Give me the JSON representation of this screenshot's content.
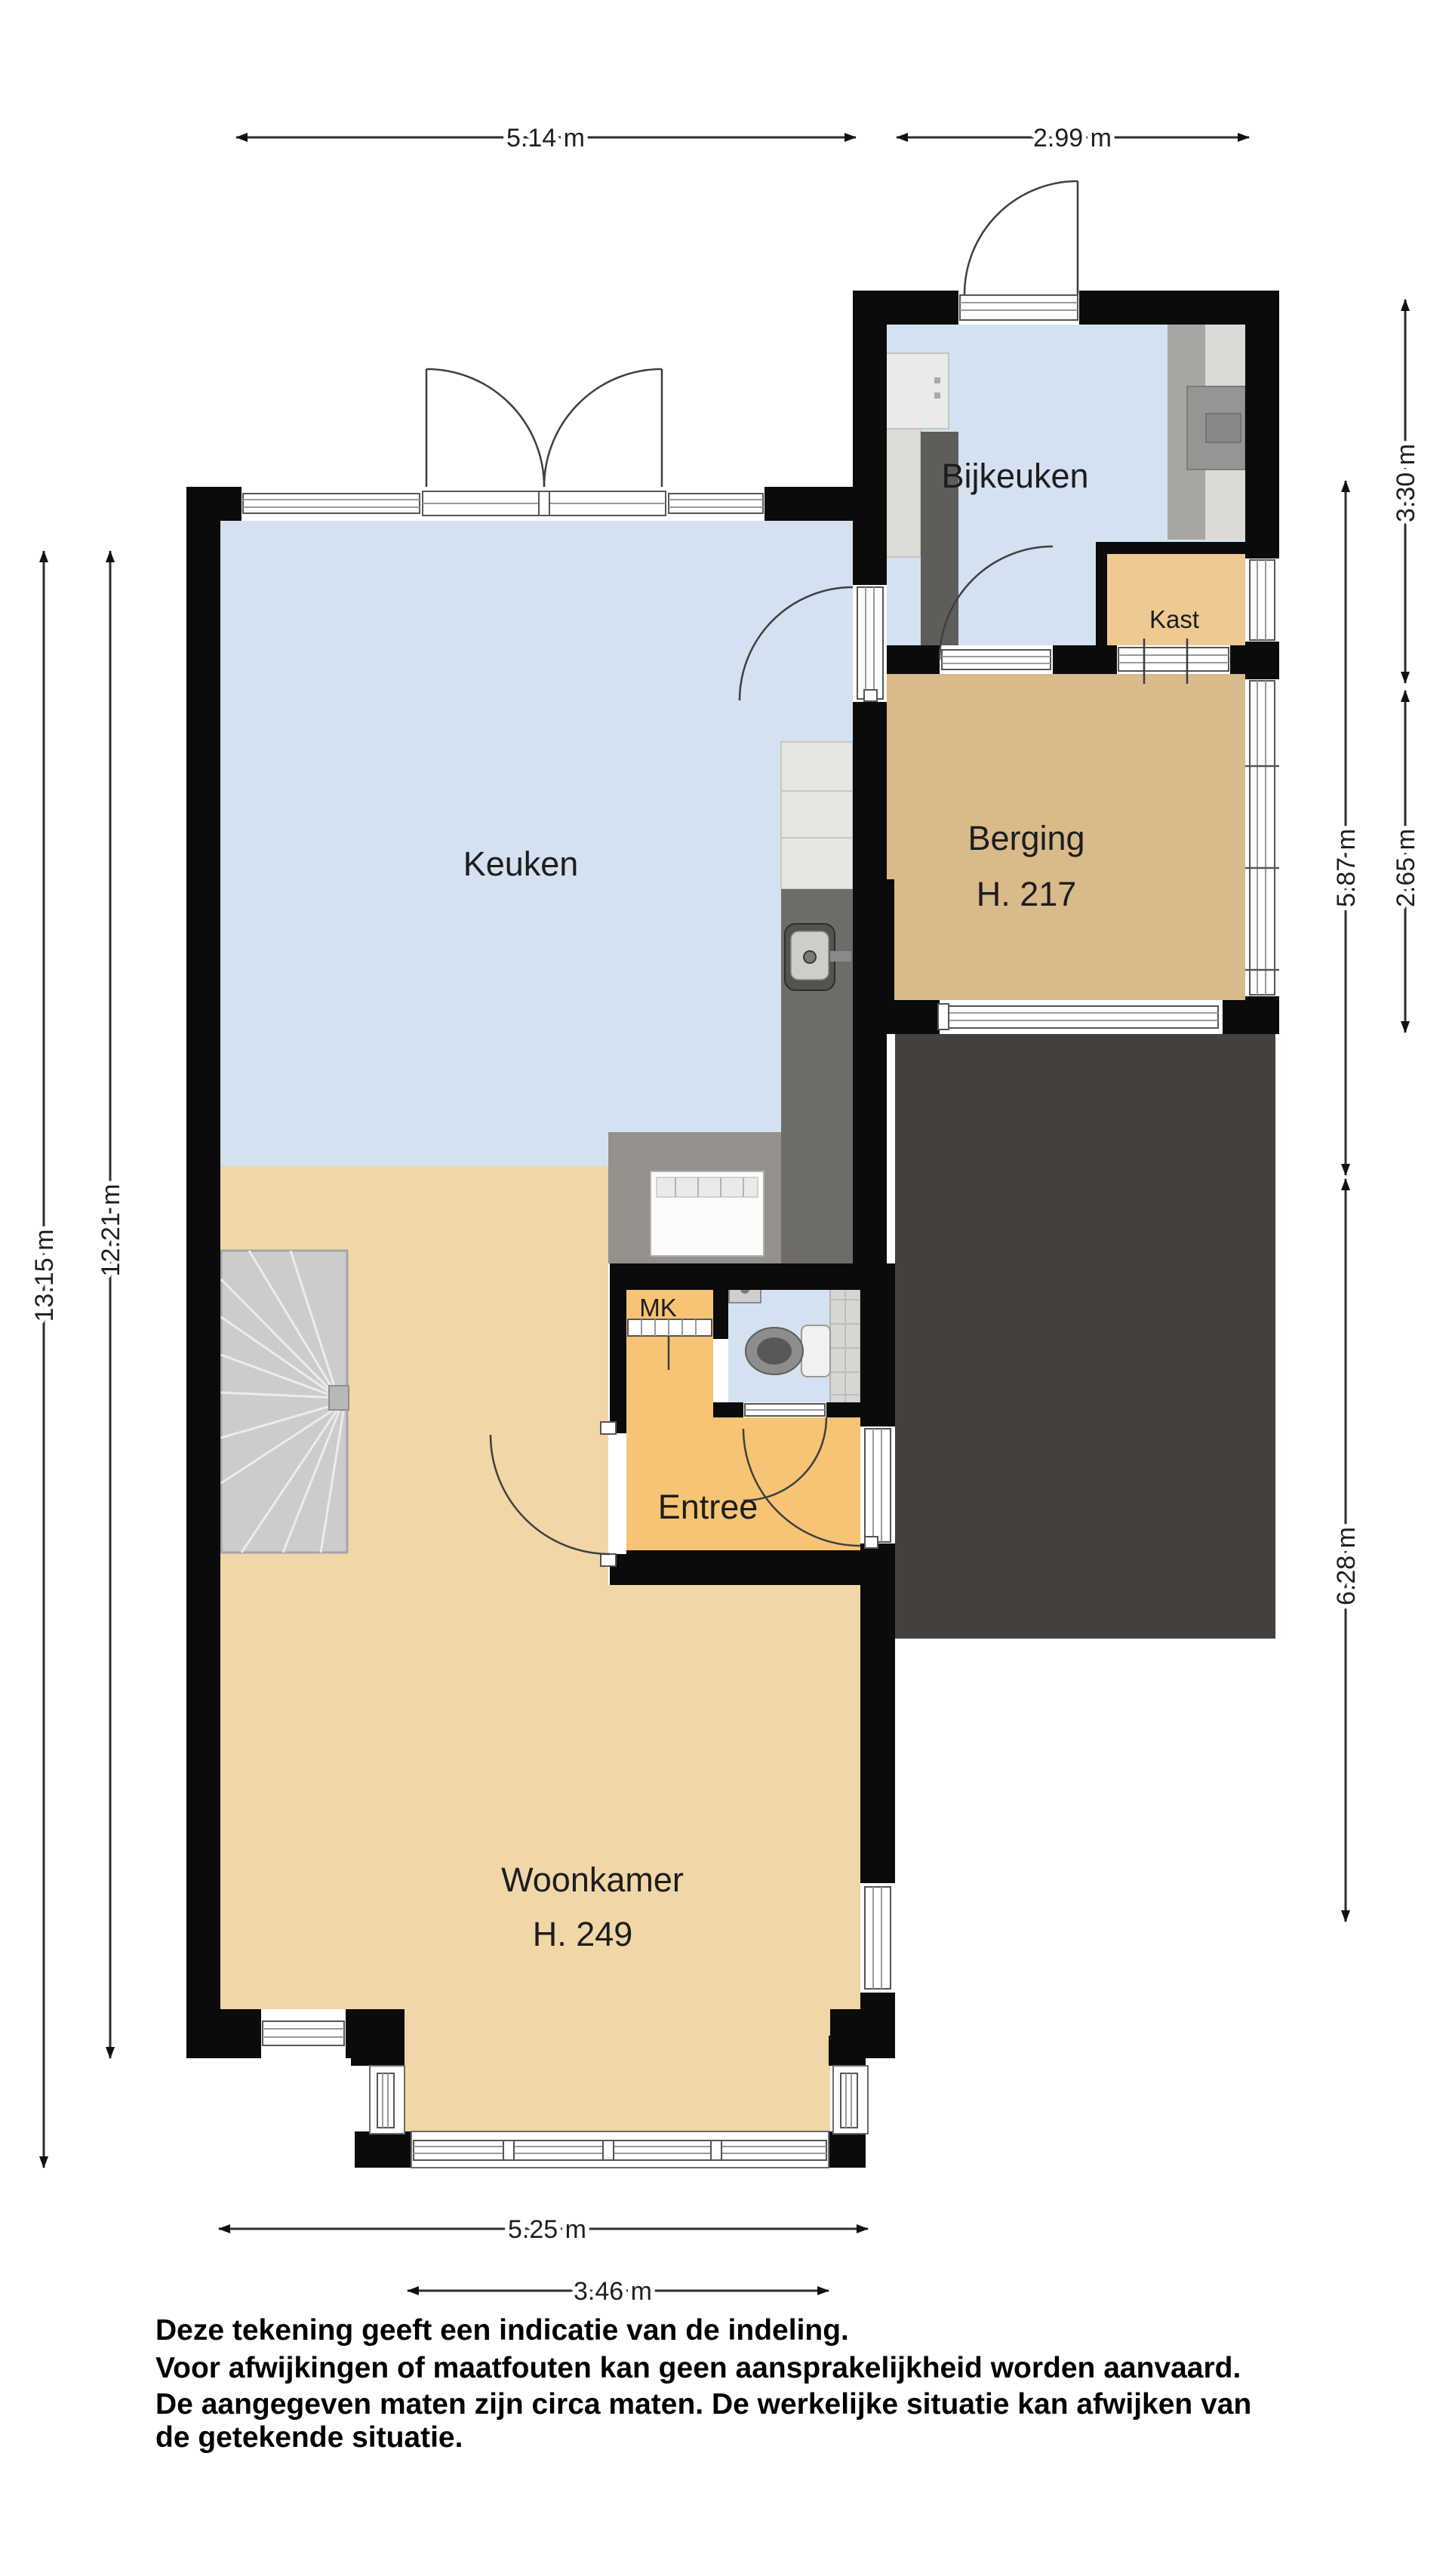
{
  "floorplan": {
    "rooms": {
      "keuken": {
        "label": "Keuken"
      },
      "bijkeuken": {
        "label": "Bijkeuken"
      },
      "kast": {
        "label": "Kast"
      },
      "berging": {
        "label": "Berging",
        "ceiling": "H. 217"
      },
      "mk": {
        "label": "MK"
      },
      "entree": {
        "label": "Entree"
      },
      "woonkamer": {
        "label": "Woonkamer",
        "ceiling": "H. 249"
      }
    },
    "dimensions": {
      "top_left": "5.14 m",
      "top_right": "2.99 m",
      "left_outer": "13.15 m",
      "left_inner": "12.21 m",
      "right_top": "3.30 m",
      "right_middle": "2.65 m",
      "right_inner_upper": "5.87 m",
      "right_inner_lower": "6.28 m",
      "bottom_outer": "5.25 m",
      "bottom_inner": "3.46 m"
    },
    "disclaimer": {
      "line1": "Deze tekening geeft een indicatie van de indeling.",
      "line2": "Voor  afwijkingen of maatfouten kan geen aansprakelijkheid worden aanvaard.",
      "line3": "De aangegeven maten zijn circa maten. De werkelijke situatie kan afwijken van",
      "line4": "de getekende situatie."
    },
    "colors": {
      "wall": "#0b0b0b",
      "floor_blue": "#d4e1f1",
      "floor_tan": "#f1d7a7",
      "floor_orange": "#f7c475",
      "floor_kast": "#eeca92",
      "floor_berging": "#d8ba8b",
      "terrace": "#44413d",
      "stairs": "#cccccc"
    }
  }
}
